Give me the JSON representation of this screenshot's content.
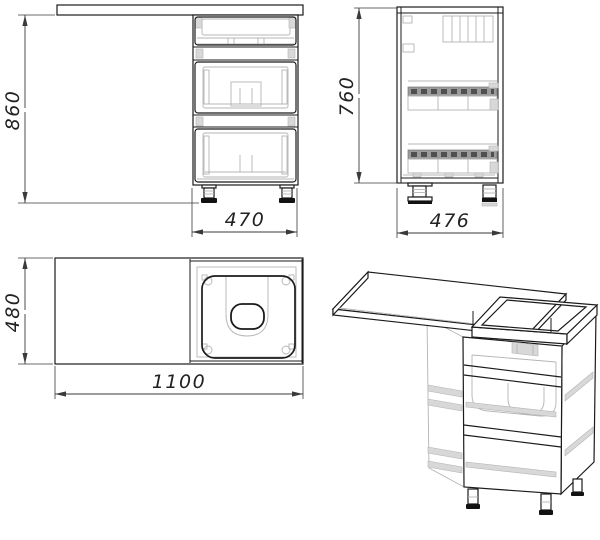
{
  "dimensions": {
    "front_height": "860",
    "front_width": "470",
    "side_height": "760",
    "side_depth": "476",
    "top_depth": "480",
    "top_length": "1100"
  },
  "colors": {
    "background": "#ffffff",
    "line": "#1b1b1b",
    "dim_line": "#3a3a3a",
    "dim_text": "#222222",
    "hidden_detail": "#b4b4b4",
    "rail_fill": "#9c9c9c",
    "rail_dash": "#4f4f4f",
    "foot": "#121212"
  }
}
